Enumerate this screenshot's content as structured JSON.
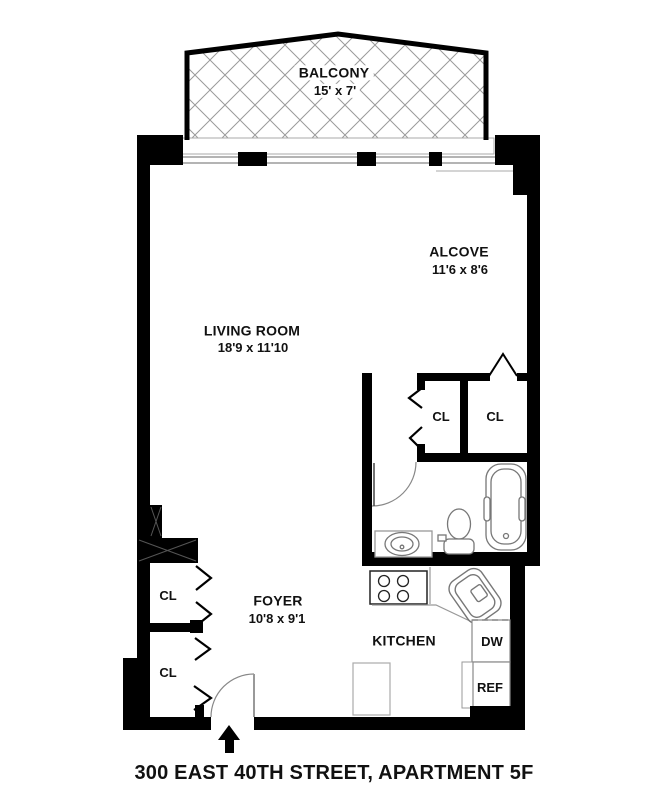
{
  "title": "300 EAST 40TH STREET, APARTMENT 5F",
  "rooms": {
    "balcony": {
      "name": "BALCONY",
      "dims": "15' x 7'"
    },
    "alcove": {
      "name": "ALCOVE",
      "dims": "11'6 x 8'6"
    },
    "living_room": {
      "name": "LIVING ROOM",
      "dims": "18'9 x 11'10"
    },
    "foyer": {
      "name": "FOYER",
      "dims": "10'8 x 9'1"
    },
    "kitchen": {
      "name": "KITCHEN"
    }
  },
  "closets": {
    "label": "CL"
  },
  "appliances": {
    "dishwasher": "DW",
    "refrigerator": "REF"
  },
  "icons": {
    "entry_arrow": "entrance-up-arrow"
  },
  "colors": {
    "wall": "#000000",
    "fixture_line": "#777777",
    "counter_line": "#999999",
    "window_line": "#888888",
    "hatch_line": "#9a9a9a",
    "text": "#111111",
    "background": "#ffffff"
  }
}
